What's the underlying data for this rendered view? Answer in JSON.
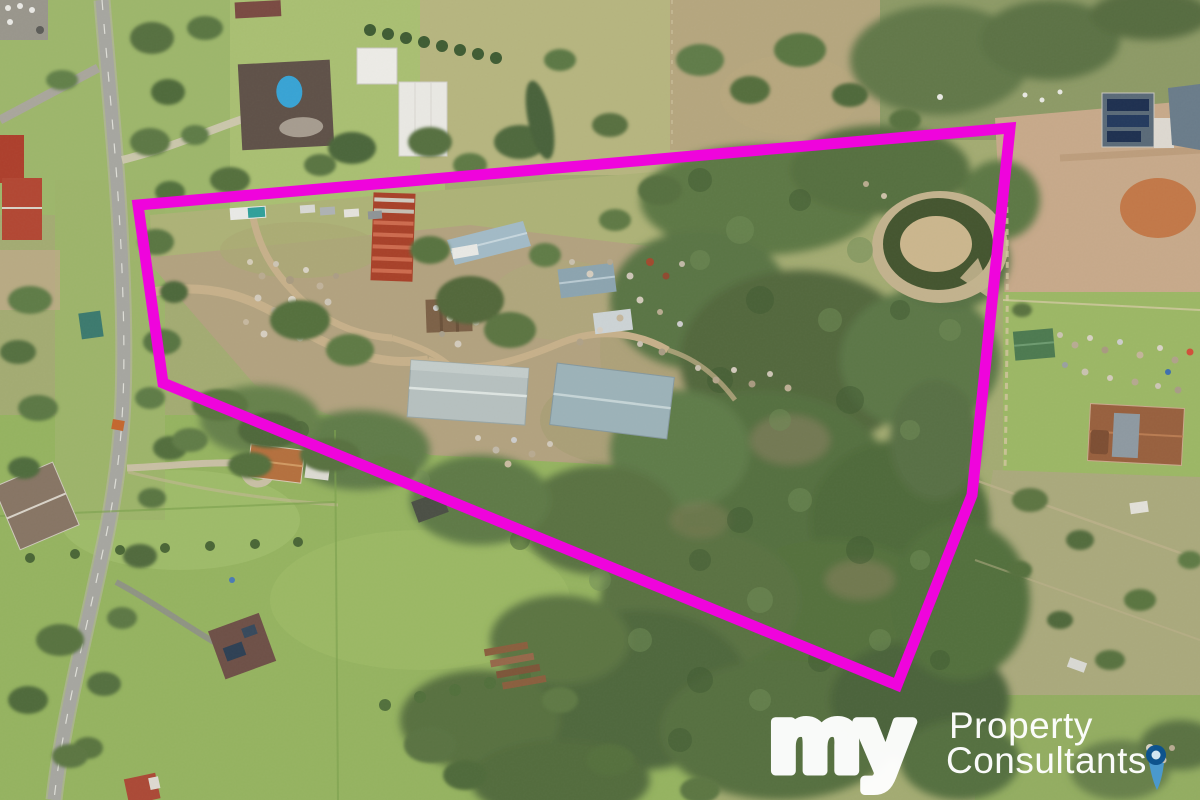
{
  "meta": {
    "kind": "aerial-drone-photograph",
    "subject": "acreage property for sale with storage yard, sheds, bushland, dam and road frontage",
    "width_px": 1200,
    "height_px": 800
  },
  "boundary": {
    "color": "#ef04dc",
    "stroke_width": 11,
    "points": "138,205 1010,128 972,495 897,685 163,383"
  },
  "watermark": {
    "logo_script": "my",
    "name_line1": "Property",
    "name_line2": "Consultants",
    "text_color": "#ffffff",
    "pin_outer_color": "#0b5290",
    "pin_tail_color": "#4a9ad2",
    "pin_dot_color": "#d6eaf7"
  },
  "scene": {
    "landmarks": [
      "road along left edge",
      "estate house with swimming pool top-left",
      "red corrugated shed",
      "two large grey warehouses",
      "storage yard with scattered materials",
      "horseshoe dam in bushland",
      "dense bushland right half",
      "solar panel house top-right",
      "paddocks and houses bottom-left"
    ],
    "palette": {
      "grass_khaki": "#aab173",
      "pasture_green": "#95b360",
      "forest_dark": "#52683e",
      "forest_mid": "#5a7542",
      "yard_dirt": "#b2a27f",
      "dirt_tan": "#c7a98a",
      "dirt_orange": "#c1703c",
      "road_gray": "#a6a6a0",
      "red_shed": "#a84129",
      "warehouse_gray": "#9cb2b8",
      "pool_blue": "#38a3d4",
      "solar_blue": "#1e3050",
      "pond_dark": "#44552f"
    }
  }
}
